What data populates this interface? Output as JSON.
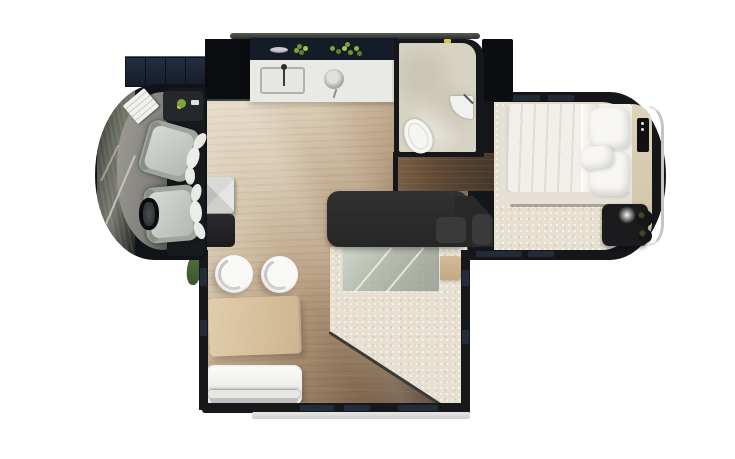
{
  "scene": {
    "title": "Motorhome interior floor plan, top-down 3D render",
    "background": "#ffffff",
    "canvas": {
      "width": 735,
      "height": 459
    }
  },
  "palette": {
    "shell_dark": "#14161a",
    "wood_floor_light": "#dcccb4",
    "wood_floor_dark": "#5a4734",
    "corridor_wood": "#5d4833",
    "counter_white": "#e9e9e5",
    "bathroom_tile": "#d7d3c3",
    "carpet_cream": "#e7e0d0",
    "island_charcoal": "#2d2d2d",
    "table_wood": "#d8c2a0",
    "sofa_white": "#f1f1ef",
    "bed_white": "#f1efe8",
    "step_panel_navy": "#1a2130",
    "herb_green": "#7ca23e",
    "accent_yellow": "#d8ca3e",
    "chrome_trim": "#c4c4c2"
  },
  "areas": {
    "cab": {
      "label": "Driver cab with two swivel seats, steering wheel, dashboard and laptop"
    },
    "entry_step": {
      "label": "Segmented entry step panel"
    },
    "kitchen": {
      "label": "Galley kitchen with rectangular sink, faucet, round basin and herb shelf"
    },
    "bathroom": {
      "label": "Bathroom with toilet and corner sink"
    },
    "corridor": {
      "label": "Dark wood corridor between bathroom and bedroom"
    },
    "living": {
      "label": "Living area slide-out with wood table, two stools, sofa, glass panel and cream rug"
    },
    "island": {
      "label": "Charcoal kitchen island with drawers"
    },
    "bedroom": {
      "label": "Rear bedroom with double bed, pillows, side shelf, TV panel and nightstand with lamp"
    }
  },
  "furniture": {
    "stool_count": 2,
    "pillow_count": 2,
    "seat_names": [
      "passenger-seat",
      "driver-seat"
    ]
  }
}
